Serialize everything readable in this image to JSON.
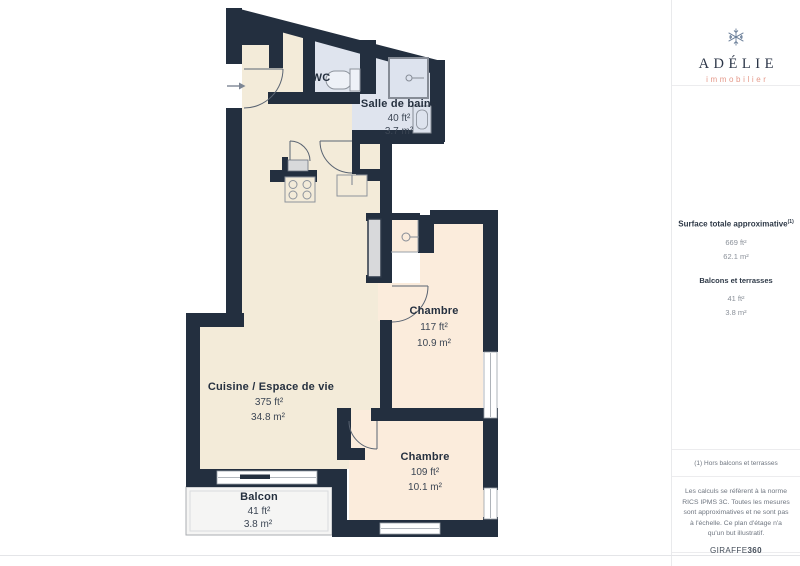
{
  "branding": {
    "name": "ADÉLIE",
    "subtitle": "immobilier",
    "name_color": "#2b3547",
    "subtitle_color": "#e5998a"
  },
  "sidebar": {
    "surface_title": "Surface totale approximative",
    "surface_superscript": "(1)",
    "surface_values": [
      "669 ft²",
      "62.1 m²"
    ],
    "balcony_title": "Balcons et terrasses",
    "balcony_values": [
      "41 ft²",
      "3.8 m²"
    ],
    "footnote": "(1) Hors balcons et terrasses",
    "disclaimer": "Les calculs se réfèrent à la norme RICS IPMS 3C. Toutes les mesures sont approximatives et ne sont pas à l'échelle. Ce plan d'étage n'a qu'un but illustratif.",
    "credit_name": "GIRAFFE",
    "credit_number": "360"
  },
  "floorplan": {
    "rooms": {
      "wc": {
        "name": "WC"
      },
      "bathroom": {
        "name": "Salle de bains",
        "area_ft": "40 ft²",
        "area_m": "3.7 m²"
      },
      "bedroom1": {
        "name": "Chambre",
        "area_ft": "117 ft²",
        "area_m": "10.9 m²"
      },
      "living": {
        "name": "Cuisine / Espace de vie",
        "area_ft": "375 ft²",
        "area_m": "34.8 m²"
      },
      "bedroom2": {
        "name": "Chambre",
        "area_ft": "109 ft²",
        "area_m": "10.1 m²"
      },
      "balcony": {
        "name": "Balcon",
        "area_ft": "41 ft²",
        "area_m": "3.8 m²"
      }
    },
    "colors": {
      "wall": "#232f3f",
      "living_floor": "#f3ebd9",
      "bedroom_floor": "#fbecdc",
      "wet_floor": "#dfe4ee",
      "balcony_floor": "#f5f5f4"
    }
  }
}
